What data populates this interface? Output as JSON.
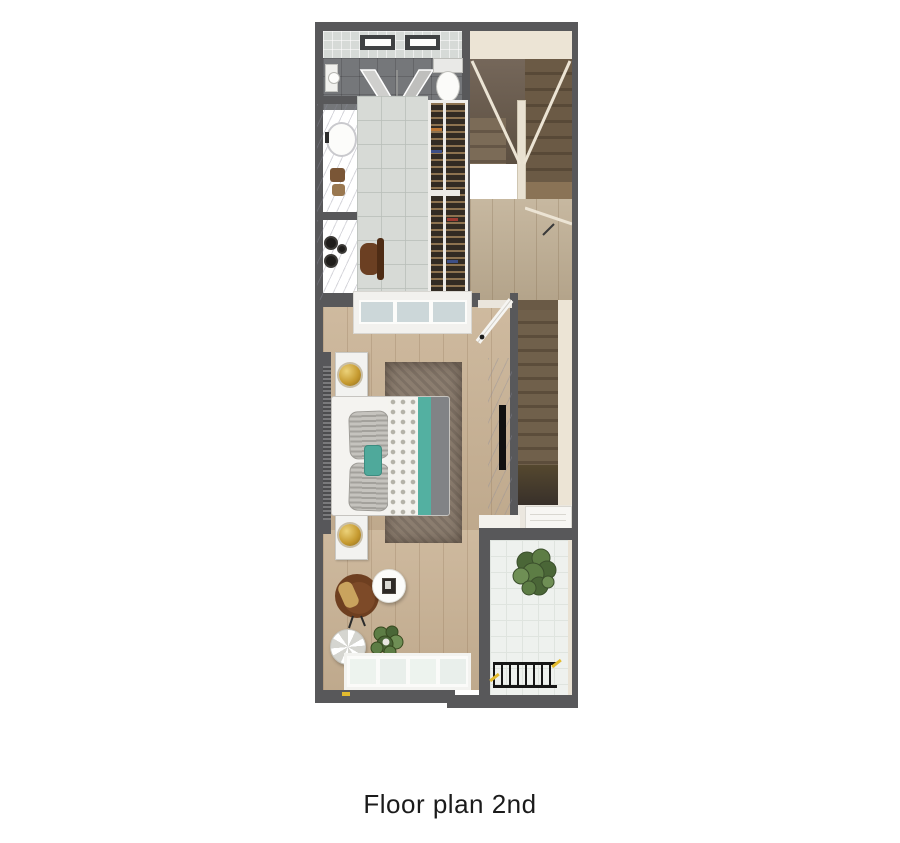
{
  "caption": {
    "text": "Floor plan 2nd"
  },
  "plan": {
    "floor_label": "2nd",
    "rooms": [
      "bathroom",
      "dressing-area",
      "stair-hall",
      "bedroom",
      "balcony"
    ],
    "colors": {
      "wall": "#58585a",
      "background": "#ffffff",
      "caption": "#1b1b1b",
      "wood": "#c9b294",
      "wood_hall": "#bfae93",
      "tread": "#6e5c48",
      "tread_dark": "#4a3c2e",
      "cream": "#ece4d5",
      "bath_tile": "#d6dad7",
      "shower": "#75777a",
      "marble": "#ebebee",
      "rug": "#8b7d6f",
      "teal": "#4fa99b",
      "gold": "#c5992f",
      "balc": "#eef1ee",
      "green": "#55713d",
      "chair_brown": "#6e3f20",
      "accent_yellow": "#e3bb2e"
    }
  }
}
